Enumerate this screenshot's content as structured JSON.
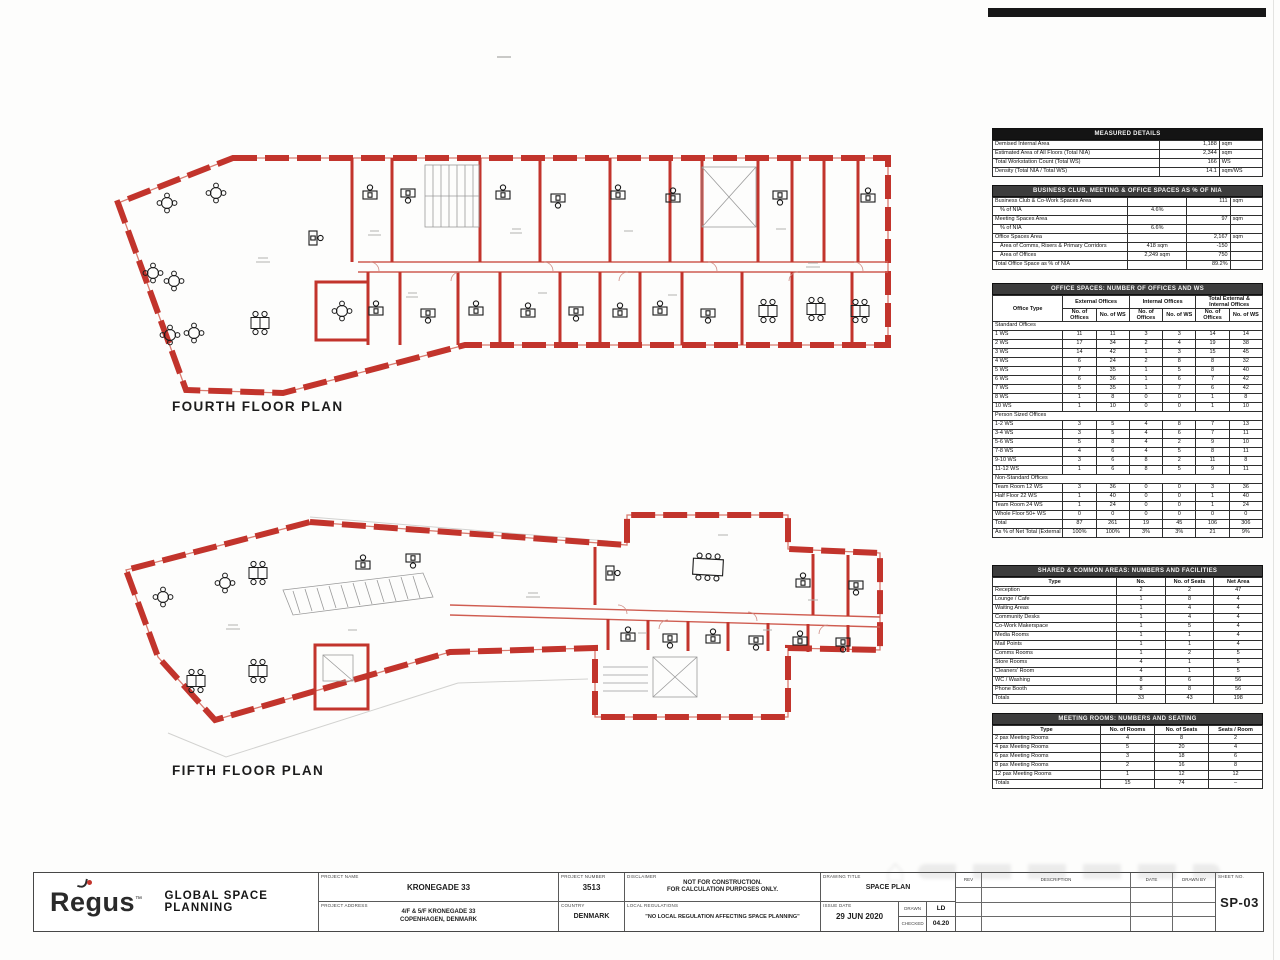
{
  "sheet": {
    "watermark_glyph": "⌂"
  },
  "plans": {
    "fourth_label": "FOURTH FLOOR PLAN",
    "fifth_label": "FIFTH FLOOR PLAN"
  },
  "panel": {
    "measured": {
      "title": "MEASURED DETAILS",
      "rows": [
        {
          "label": "Demised Internal Area",
          "value": "1,188",
          "unit": "sqm"
        },
        {
          "label": "Estimated Area of All Floors (Total NIA)",
          "value": "2,344",
          "unit": "sqm"
        },
        {
          "label": "Total Workstation Count (Total WS)",
          "value": "166",
          "unit": "WS"
        },
        {
          "label": "Density (Total NIA / Total WS)",
          "value": "14.1",
          "unit": "sqm/WS"
        }
      ]
    },
    "ratios": {
      "title": "BUSINESS CLUB, MEETING & OFFICE SPACES AS % OF NIA",
      "rows": [
        {
          "label": "Business Club & Co-Work Spaces Area",
          "mid": "",
          "value": "111",
          "unit": "sqm",
          "indent": false
        },
        {
          "label": "% of NIA",
          "mid": "4.6%",
          "value": "",
          "unit": "",
          "indent": true
        },
        {
          "label": "Meeting Spaces Area",
          "mid": "",
          "value": "97",
          "unit": "sqm",
          "indent": false
        },
        {
          "label": "% of NIA",
          "mid": "6.6%",
          "value": "",
          "unit": "",
          "indent": true
        },
        {
          "label": "Office Spaces Area",
          "mid": "",
          "value": "2,167",
          "unit": "sqm",
          "indent": false
        },
        {
          "label": "Area of Comms, Risers & Primary Corridors",
          "mid": "418 sqm",
          "value": "-150",
          "unit": "",
          "indent": true
        },
        {
          "label": "Area of Offices",
          "mid": "2,249 sqm",
          "value": "750",
          "unit": "",
          "indent": true
        },
        {
          "label": "Total Office Space as % of NIA",
          "mid": "",
          "value": "89.2%",
          "unit": "",
          "indent": false
        }
      ]
    },
    "offices": {
      "title": "OFFICE SPACES: NUMBER OF OFFICES AND WS",
      "col_type": "Office Type",
      "groups": [
        "External Offices",
        "Internal Offices",
        "Total External & Internal Offices"
      ],
      "sub": [
        "No. of Offices",
        "No. of WS",
        "No. of Offices",
        "No. of WS",
        "No. of Offices",
        "No. of WS"
      ],
      "sections": [
        {
          "name": "Standard Offices",
          "rows": [
            {
              "type": "1 WS",
              "c": [
                "11",
                "11",
                "3",
                "3",
                "14",
                "14"
              ]
            },
            {
              "type": "2 WS",
              "c": [
                "17",
                "34",
                "2",
                "4",
                "19",
                "38"
              ]
            },
            {
              "type": "3 WS",
              "c": [
                "14",
                "42",
                "1",
                "3",
                "15",
                "45"
              ]
            },
            {
              "type": "4 WS",
              "c": [
                "6",
                "24",
                "2",
                "8",
                "8",
                "32"
              ]
            },
            {
              "type": "5 WS",
              "c": [
                "7",
                "35",
                "1",
                "5",
                "8",
                "40"
              ]
            },
            {
              "type": "6 WS",
              "c": [
                "6",
                "36",
                "1",
                "6",
                "7",
                "42"
              ]
            },
            {
              "type": "7 WS",
              "c": [
                "5",
                "35",
                "1",
                "7",
                "6",
                "42"
              ]
            },
            {
              "type": "8 WS",
              "c": [
                "1",
                "8",
                "0",
                "0",
                "1",
                "8"
              ]
            },
            {
              "type": "10 WS",
              "c": [
                "1",
                "10",
                "0",
                "0",
                "1",
                "10"
              ]
            }
          ]
        },
        {
          "name": "Person Sized Offices",
          "rows": [
            {
              "type": "1-2 WS",
              "c": [
                "3",
                "5",
                "4",
                "8",
                "7",
                "13"
              ]
            },
            {
              "type": "3-4 WS",
              "c": [
                "3",
                "5",
                "4",
                "6",
                "7",
                "11"
              ]
            },
            {
              "type": "5-6 WS",
              "c": [
                "5",
                "8",
                "4",
                "2",
                "9",
                "10"
              ]
            },
            {
              "type": "7-8 WS",
              "c": [
                "4",
                "6",
                "4",
                "5",
                "8",
                "11"
              ]
            },
            {
              "type": "9-10 WS",
              "c": [
                "3",
                "6",
                "8",
                "2",
                "11",
                "8"
              ]
            },
            {
              "type": "11-12 WS",
              "c": [
                "1",
                "6",
                "8",
                "5",
                "9",
                "11"
              ]
            }
          ]
        },
        {
          "name": "Non-Standard Offices",
          "rows": [
            {
              "type": "Team Room 12 WS",
              "c": [
                "3",
                "36",
                "0",
                "0",
                "3",
                "36"
              ]
            },
            {
              "type": "Half Floor 22 WS",
              "c": [
                "1",
                "40",
                "0",
                "0",
                "1",
                "40"
              ]
            },
            {
              "type": "Team Room 24 WS",
              "c": [
                "1",
                "24",
                "0",
                "0",
                "1",
                "24"
              ]
            },
            {
              "type": "Whole Floor 50+ WS",
              "c": [
                "0",
                "0",
                "0",
                "0",
                "0",
                "0"
              ]
            }
          ]
        }
      ],
      "total": {
        "type": "Total",
        "c": [
          "87",
          "261",
          "19",
          "45",
          "106",
          "306"
        ]
      },
      "percent": {
        "type": "As % of Net Total (External & Internal Offices)",
        "c": [
          "100%",
          "100%",
          "3%",
          "3%",
          "21",
          "9%"
        ]
      }
    },
    "shared": {
      "title": "SHARED & COMMON AREAS: NUMBERS AND FACILITIES",
      "head": [
        "Type",
        "No.",
        "No. of Seats",
        "Net Area"
      ],
      "rows": [
        {
          "type": "Reception",
          "c": [
            "2",
            "2",
            "47"
          ]
        },
        {
          "type": "Lounge / Cafe",
          "c": [
            "1",
            "8",
            "4"
          ]
        },
        {
          "type": "Waiting Areas",
          "c": [
            "1",
            "4",
            "4"
          ]
        },
        {
          "type": "Community Desks",
          "c": [
            "1",
            "4",
            "4"
          ]
        },
        {
          "type": "Co-Work Makerspace",
          "c": [
            "1",
            "5",
            "4"
          ]
        },
        {
          "type": "Media Rooms",
          "c": [
            "1",
            "1",
            "4"
          ]
        },
        {
          "type": "Mail Points",
          "c": [
            "1",
            "1",
            "4"
          ]
        },
        {
          "type": "Comms Rooms",
          "c": [
            "1",
            "2",
            "5"
          ]
        },
        {
          "type": "Store Rooms",
          "c": [
            "4",
            "1",
            "5"
          ]
        },
        {
          "type": "Cleaners' Room",
          "c": [
            "4",
            "1",
            "5"
          ]
        },
        {
          "type": "WC / Washing",
          "c": [
            "8",
            "6",
            "56"
          ]
        },
        {
          "type": "Phone Booth",
          "c": [
            "8",
            "8",
            "56"
          ]
        },
        {
          "type": "Totals",
          "c": [
            "33",
            "43",
            "198"
          ]
        }
      ]
    },
    "meeting": {
      "title": "MEETING ROOMS: NUMBERS AND SEATING",
      "head": [
        "Type",
        "No. of Rooms",
        "No. of Seats",
        "Seats / Room"
      ],
      "rows": [
        {
          "type": "2 pax Meeting Rooms",
          "c": [
            "4",
            "8",
            "2"
          ]
        },
        {
          "type": "4 pax Meeting Rooms",
          "c": [
            "5",
            "20",
            "4"
          ]
        },
        {
          "type": "6 pax Meeting Rooms",
          "c": [
            "3",
            "18",
            "6"
          ]
        },
        {
          "type": "8 pax Meeting Rooms",
          "c": [
            "2",
            "16",
            "8"
          ]
        },
        {
          "type": "12 pax Meeting Rooms",
          "c": [
            "1",
            "12",
            "12"
          ]
        },
        {
          "type": "Totals",
          "c": [
            "15",
            "74",
            "–"
          ]
        }
      ]
    }
  },
  "titleblock": {
    "brand": "Regus",
    "brand_sup": "™",
    "dept": "GLOBAL SPACE PLANNING",
    "labels": {
      "project_name": "PROJECT NAME",
      "project_address": "PROJECT ADDRESS",
      "project_number": "PROJECT NUMBER",
      "country": "COUNTRY",
      "disclaimer": "DISCLAIMER",
      "regulations": "LOCAL REGULATIONS",
      "drawing_title": "DRAWING TITLE",
      "issue_date": "ISSUE DATE",
      "drawn": "DRAWN",
      "checked": "CHECKED",
      "sheet_no": "SHEET NO.",
      "rev": "REV",
      "description": "DESCRIPTION",
      "date": "DATE",
      "drawn_by": "DRAWN BY"
    },
    "values": {
      "project_name": "KRONEGADE 33",
      "address_line1": "4/F & 5/F KRONEGADE 33",
      "address_line2": "COPENHAGEN, DENMARK",
      "project_number": "3513",
      "country": "DENMARK",
      "disclaimer_line1": "NOT FOR CONSTRUCTION.",
      "disclaimer_line2": "FOR CALCULATION PURPOSES ONLY.",
      "regulations": "\"NO LOCAL REGULATION AFFECTING SPACE PLANNING\"",
      "drawing_title": "SPACE PLAN",
      "issue_date": "29 JUN 2020",
      "drawn": "LD",
      "checked": "04.20",
      "sheet_no": "SP-03"
    }
  }
}
